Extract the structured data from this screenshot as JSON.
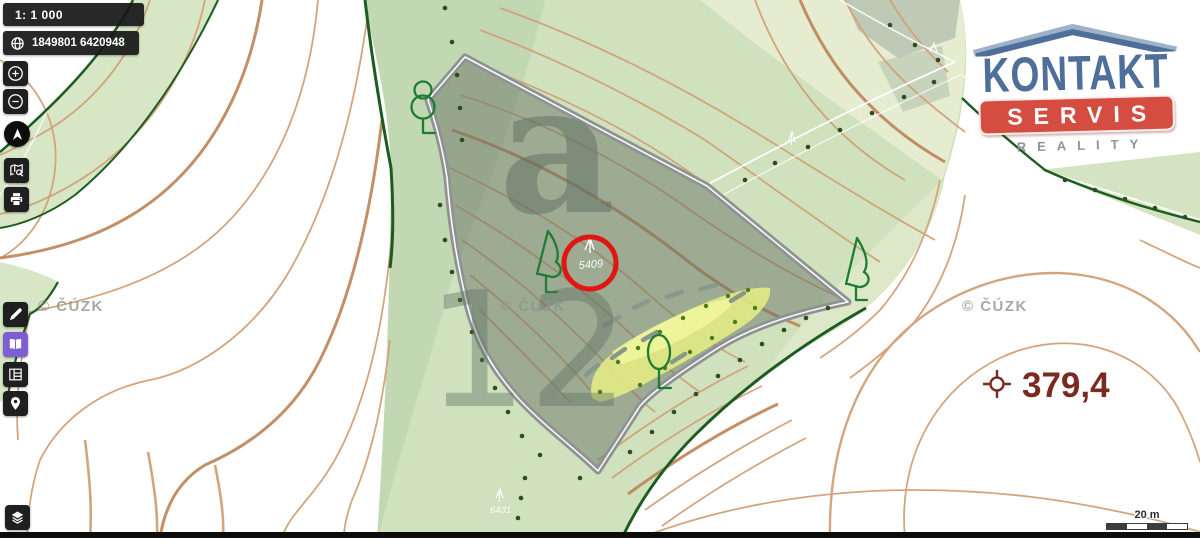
{
  "toolbar": {
    "scale_indicator": "1: 1 000",
    "coordinates": "1849801 6420948",
    "buttons": [
      "zoom-in",
      "zoom-out",
      "compass",
      "search-map",
      "print",
      "measure",
      "map-book",
      "legend",
      "location-pin",
      "layers"
    ]
  },
  "logo": {
    "title": "KONTAKT",
    "subtitle": "SERVIS",
    "tagline": "REALITY"
  },
  "map": {
    "highlight_point_label": "5409",
    "parcel_letter": "a",
    "parcel_number": "12",
    "parcel_number_secondary": "6431",
    "elevation_label": "379,4",
    "watermark": "© ČÚZK",
    "scalebar_label": "20 m"
  },
  "colors": {
    "accent_purple": "#7e5fd3",
    "highlight_circle_red": "#e11512",
    "elevation_brown": "#7b2a22",
    "contour_tan": "#d1a178",
    "forest_edge_green": "#1d5c20",
    "parcel_border_gray": "#8e9392",
    "clearing_yellow": "#e6ee82",
    "ghost_label_green": "#5f7263"
  }
}
